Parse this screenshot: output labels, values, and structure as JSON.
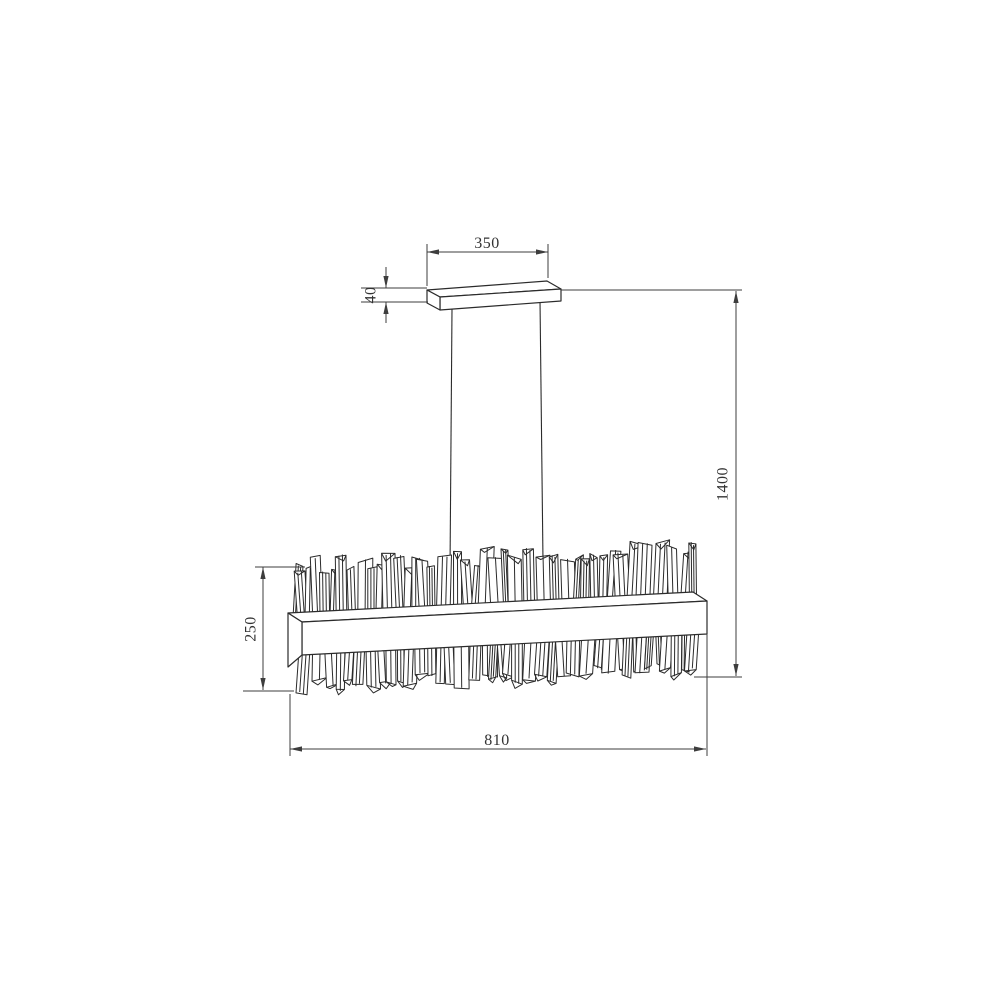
{
  "page": {
    "background_color": "#ffffff"
  },
  "drawing": {
    "subject": "linear crystal chandelier pendant - dimension drawing",
    "line_color": "#2b2b2b",
    "dimension_line_color": "#3d3d3d",
    "text_color": "#333333",
    "dimensions": {
      "canopy_width": "350",
      "canopy_thickness": "40",
      "overall_drop": "1400",
      "body_height": "250",
      "body_width": "810"
    }
  }
}
